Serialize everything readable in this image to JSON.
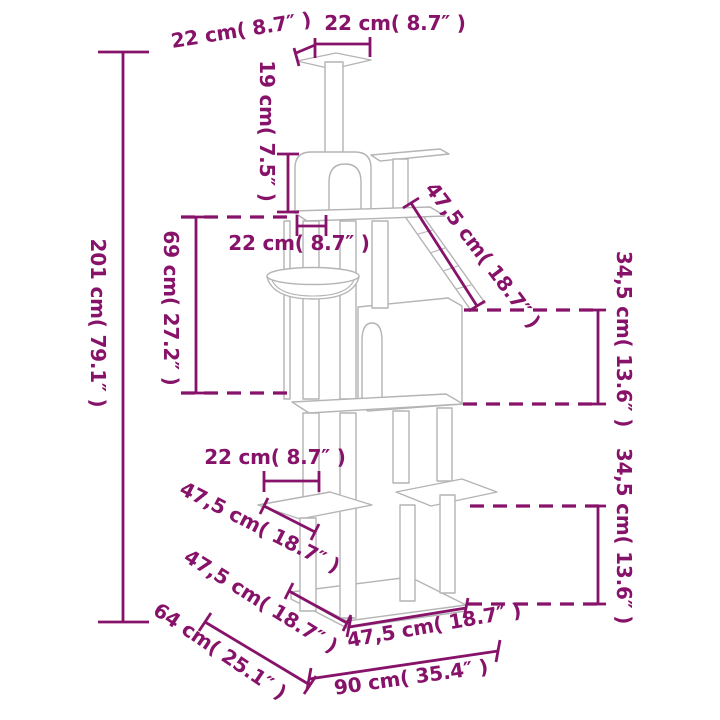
{
  "title": "Cat tree dimension diagram",
  "colors": {
    "dimension_ink": "#871269",
    "drawing_outline": "#b4b4b4",
    "background": "#ffffff"
  },
  "labels": {
    "top_depth": "22 cm( 8.7″ )",
    "top_width": "22 cm( 8.7″ )",
    "top_post_height": "19 cm( 7.5″ )",
    "total_height": "201 cm( 79.1″ )",
    "middle_section_height": "69 cm( 27.2″ )",
    "middle_shelf_depth": "22 cm( 8.7″ )",
    "ramp_length": "47,5 cm( 18.7″ )",
    "upper_right_height": "34,5 cm( 13.6″ )",
    "lower_right_height": "34,5 cm( 13.6″ )",
    "lower_shelf_width": "22 cm( 8.7″ )",
    "lower_step_depth": "47,5 cm( 18.7″ )",
    "base_left_edge": "47,5 cm( 18.7″ )",
    "base_diagonal": "64 cm( 25.1″ )",
    "base_front_edge": "47,5 cm( 18.7″ )",
    "base_width": "90 cm( 35.4″ )"
  }
}
